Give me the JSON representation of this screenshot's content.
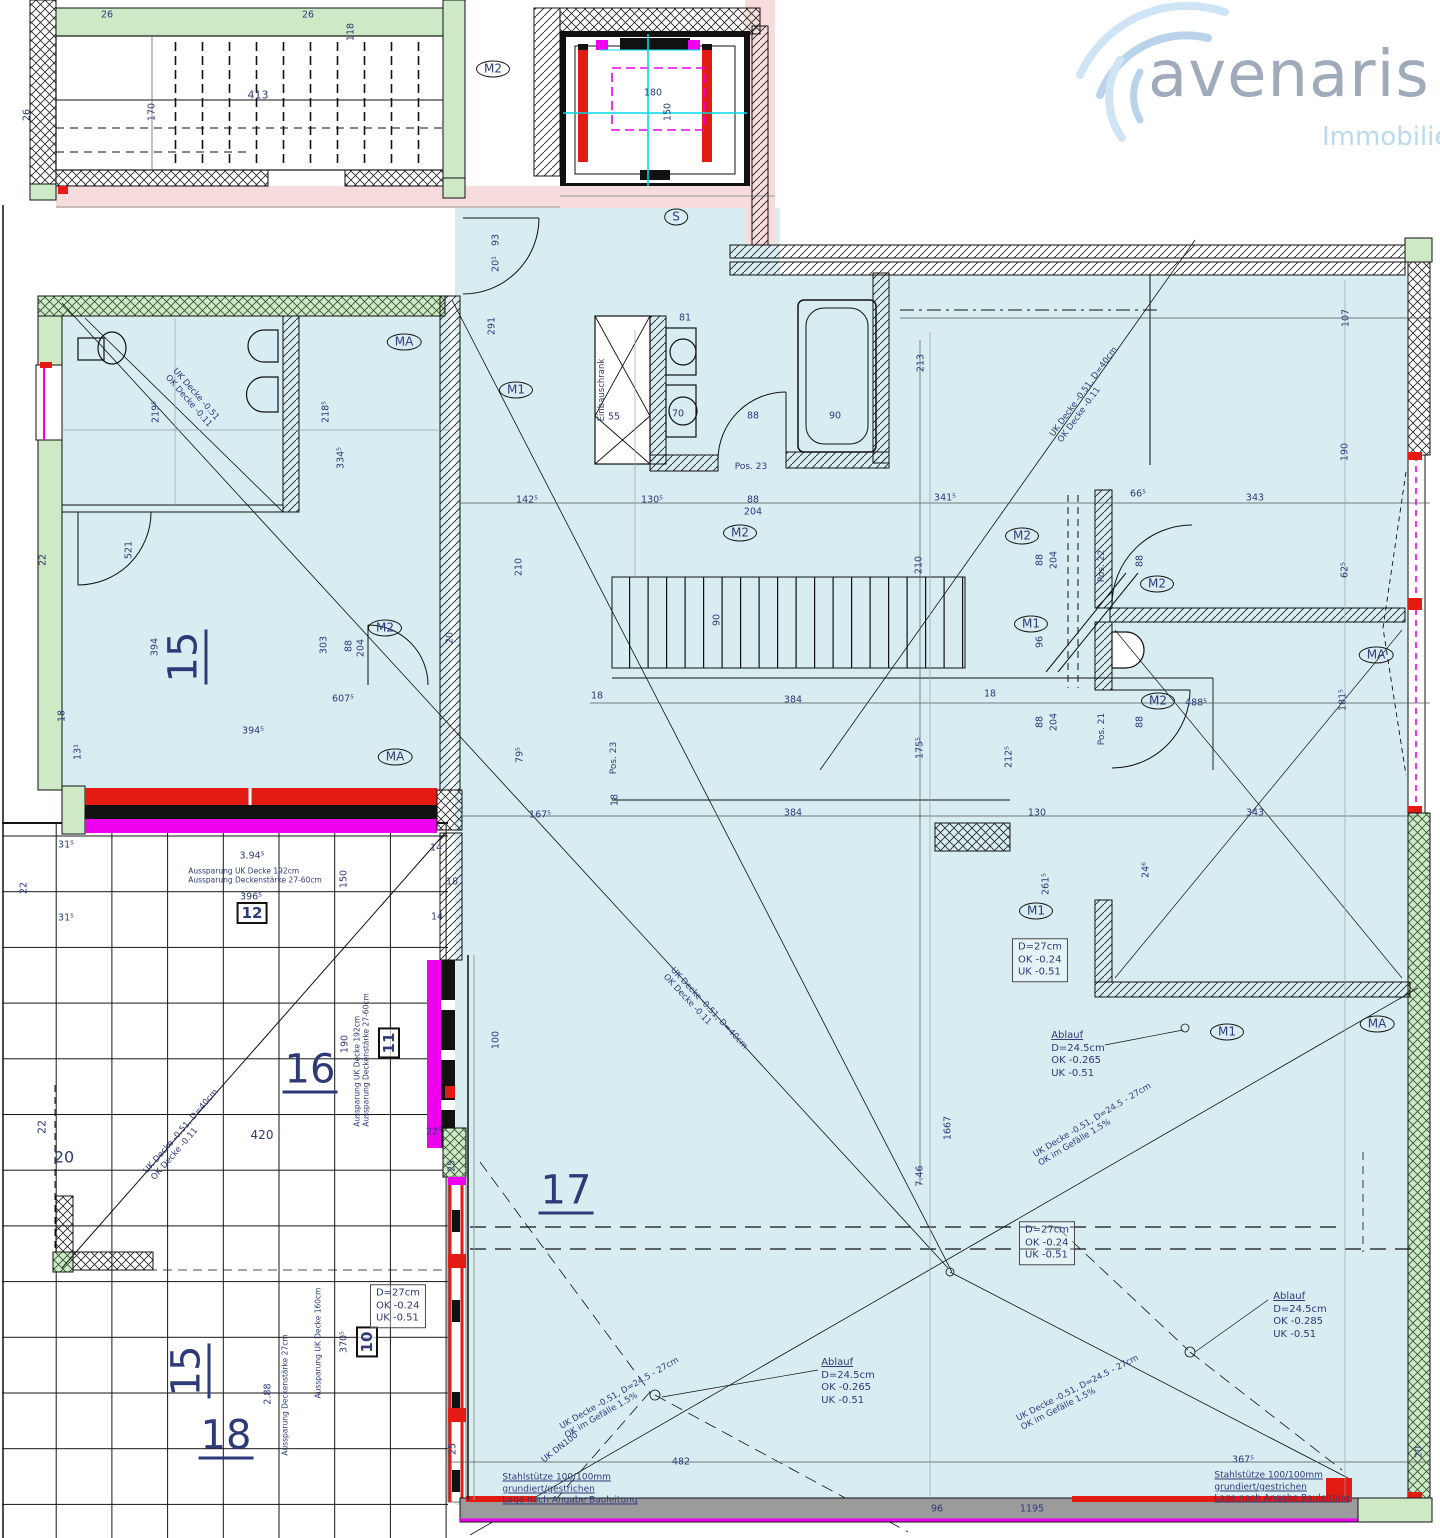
{
  "logo": {
    "brand": "avenaris",
    "subtitle": "Immobilien"
  },
  "colors": {
    "room_fill": "#d8edf2",
    "wall_green": "#cde9c6",
    "pink": "#f6dcdc",
    "magenta": "#ee00ee",
    "red": "#e31b12",
    "cyan": "#00d8e8",
    "text_navy": "#2e3a78",
    "wall_gray": "#9b9b9b",
    "logo_text": "#9faaba",
    "logo_sub": "#bcd9ec"
  },
  "plan": {
    "labels": [
      {
        "t": "26",
        "x": 107,
        "y": 15,
        "cls": "dim"
      },
      {
        "t": "26",
        "x": 308,
        "y": 15,
        "cls": "dim"
      },
      {
        "t": "413",
        "x": 258,
        "y": 95,
        "cls": "dim",
        "s": 11
      },
      {
        "t": "118",
        "x": 351,
        "y": 32,
        "r": -90,
        "cls": "dim"
      },
      {
        "t": "170",
        "x": 152,
        "y": 112,
        "r": -90,
        "cls": "dim"
      },
      {
        "t": "26",
        "x": 27,
        "y": 115,
        "r": -90,
        "cls": "dim"
      },
      {
        "t": "180",
        "x": 653,
        "y": 93,
        "cls": "dim"
      },
      {
        "t": "150",
        "x": 668,
        "y": 112,
        "r": -90,
        "cls": "dim"
      },
      {
        "t": "93",
        "x": 496,
        "y": 240,
        "r": -90,
        "cls": "dim"
      },
      {
        "t": "20¹",
        "x": 496,
        "y": 264,
        "r": -90,
        "cls": "dim"
      },
      {
        "t": "291",
        "x": 492,
        "y": 326,
        "r": -90,
        "cls": "dim"
      },
      {
        "t": "81",
        "x": 685,
        "y": 318,
        "cls": "dim"
      },
      {
        "t": "55",
        "x": 614,
        "y": 417,
        "cls": "dim"
      },
      {
        "t": "70",
        "x": 678,
        "y": 414,
        "cls": "dim"
      },
      {
        "t": "88",
        "x": 753,
        "y": 416,
        "cls": "dim"
      },
      {
        "t": "90",
        "x": 835,
        "y": 416,
        "cls": "dim"
      },
      {
        "t": "213",
        "x": 921,
        "y": 363,
        "r": -90,
        "cls": "dim"
      },
      {
        "t": "219⁵",
        "x": 156,
        "y": 412,
        "r": -90,
        "cls": "dim"
      },
      {
        "t": "218⁵",
        "x": 326,
        "y": 412,
        "r": -90,
        "cls": "dim"
      },
      {
        "t": "334⁵",
        "x": 341,
        "y": 458,
        "r": -90,
        "cls": "dim"
      },
      {
        "t": "142⁵",
        "x": 527,
        "y": 500,
        "cls": "dim"
      },
      {
        "t": "130⁵",
        "x": 652,
        "y": 500,
        "cls": "dim"
      },
      {
        "t": "88",
        "x": 753,
        "y": 500,
        "cls": "dim"
      },
      {
        "t": "204",
        "x": 753,
        "y": 512,
        "cls": "dim"
      },
      {
        "t": "341⁵",
        "x": 945,
        "y": 498,
        "cls": "dim"
      },
      {
        "t": "66⁵",
        "x": 1138,
        "y": 494,
        "cls": "dim"
      },
      {
        "t": "343",
        "x": 1255,
        "y": 498,
        "cls": "dim"
      },
      {
        "t": "107",
        "x": 1346,
        "y": 318,
        "r": -90,
        "cls": "dim"
      },
      {
        "t": "190",
        "x": 1345,
        "y": 452,
        "r": -90,
        "cls": "dim"
      },
      {
        "t": "62⁵",
        "x": 1345,
        "y": 570,
        "r": -90,
        "cls": "dim"
      },
      {
        "t": "181⁵",
        "x": 1343,
        "y": 700,
        "r": -90,
        "cls": "dim"
      },
      {
        "t": "488⁵",
        "x": 1196,
        "y": 703,
        "cls": "dim"
      },
      {
        "t": "88",
        "x": 1040,
        "y": 560,
        "r": -90,
        "cls": "dim"
      },
      {
        "t": "204",
        "x": 1054,
        "y": 560,
        "r": -90,
        "cls": "dim"
      },
      {
        "t": "88",
        "x": 1140,
        "y": 561,
        "r": -90,
        "cls": "dim"
      },
      {
        "t": "96",
        "x": 1040,
        "y": 642,
        "r": -90,
        "cls": "dim"
      },
      {
        "t": "88",
        "x": 1040,
        "y": 722,
        "r": -90,
        "cls": "dim"
      },
      {
        "t": "204",
        "x": 1054,
        "y": 722,
        "r": -90,
        "cls": "dim"
      },
      {
        "t": "88",
        "x": 1140,
        "y": 722,
        "r": -90,
        "cls": "dim"
      },
      {
        "t": "210",
        "x": 519,
        "y": 567,
        "r": -90,
        "cls": "dim"
      },
      {
        "t": "210",
        "x": 919,
        "y": 565,
        "r": -90,
        "cls": "dim"
      },
      {
        "t": "90",
        "x": 717,
        "y": 620,
        "r": -90,
        "cls": "dim"
      },
      {
        "t": "521",
        "x": 129,
        "y": 550,
        "r": -90,
        "cls": "dim"
      },
      {
        "t": "394",
        "x": 155,
        "y": 647,
        "r": -90,
        "cls": "dim"
      },
      {
        "t": "303",
        "x": 324,
        "y": 645,
        "r": -90,
        "cls": "dim"
      },
      {
        "t": "88",
        "x": 349,
        "y": 646,
        "r": -90,
        "cls": "dim"
      },
      {
        "t": "204",
        "x": 361,
        "y": 648,
        "r": -90,
        "cls": "dim"
      },
      {
        "t": "22",
        "x": 43,
        "y": 560,
        "r": -90,
        "cls": "dim"
      },
      {
        "t": "18",
        "x": 62,
        "y": 716,
        "r": -90,
        "cls": "dim"
      },
      {
        "t": "13¹",
        "x": 78,
        "y": 752,
        "r": -90,
        "cls": "dim"
      },
      {
        "t": "607⁵",
        "x": 343,
        "y": 699,
        "cls": "dim"
      },
      {
        "t": "394⁵",
        "x": 253,
        "y": 731,
        "cls": "dim"
      },
      {
        "t": "20",
        "x": 450,
        "y": 638,
        "r": -90,
        "cls": "dim"
      },
      {
        "t": "18",
        "x": 597,
        "y": 696,
        "cls": "dim"
      },
      {
        "t": "384",
        "x": 793,
        "y": 700,
        "cls": "dim"
      },
      {
        "t": "18",
        "x": 990,
        "y": 694,
        "cls": "dim"
      },
      {
        "t": "175⁵",
        "x": 920,
        "y": 748,
        "r": -90,
        "cls": "dim"
      },
      {
        "t": "212⁵",
        "x": 1009,
        "y": 757,
        "r": -90,
        "cls": "dim"
      },
      {
        "t": "18",
        "x": 615,
        "y": 800,
        "r": -90,
        "cls": "dim"
      },
      {
        "t": "384",
        "x": 793,
        "y": 813,
        "cls": "dim"
      },
      {
        "t": "130",
        "x": 1037,
        "y": 813,
        "cls": "dim"
      },
      {
        "t": "343",
        "x": 1255,
        "y": 813,
        "cls": "dim"
      },
      {
        "t": "167⁵",
        "x": 540,
        "y": 815,
        "cls": "dim"
      },
      {
        "t": "79⁵",
        "x": 520,
        "y": 755,
        "r": -90,
        "cls": "dim"
      },
      {
        "t": "261⁵",
        "x": 1046,
        "y": 884,
        "r": -90,
        "cls": "dim"
      },
      {
        "t": "24⁶",
        "x": 1146,
        "y": 870,
        "r": -90,
        "cls": "dim"
      },
      {
        "t": "31⁵",
        "x": 66,
        "y": 845,
        "cls": "dim"
      },
      {
        "t": "22",
        "x": 24,
        "y": 888,
        "r": -90,
        "cls": "dim"
      },
      {
        "t": "31⁵",
        "x": 66,
        "y": 918,
        "cls": "dim"
      },
      {
        "t": "3.94⁵",
        "x": 252,
        "y": 856,
        "cls": "dim"
      },
      {
        "t": "396⁵",
        "x": 251,
        "y": 897,
        "cls": "dim"
      },
      {
        "t": "150",
        "x": 344,
        "y": 879,
        "r": -90,
        "cls": "dim"
      },
      {
        "t": "14",
        "x": 436,
        "y": 848,
        "cls": "dim"
      },
      {
        "t": "18",
        "x": 452,
        "y": 882,
        "cls": "dim"
      },
      {
        "t": "14",
        "x": 437,
        "y": 917,
        "cls": "dim"
      },
      {
        "t": "190",
        "x": 345,
        "y": 1044,
        "r": -90,
        "cls": "dim"
      },
      {
        "t": "100",
        "x": 496,
        "y": 1040,
        "r": -90,
        "cls": "dim"
      },
      {
        "t": "22⁵",
        "x": 434,
        "y": 1132,
        "cls": "dim"
      },
      {
        "t": "25",
        "x": 452,
        "y": 1166,
        "r": -90,
        "cls": "dim"
      },
      {
        "t": "420",
        "x": 262,
        "y": 1135,
        "cls": "dim",
        "s": 12
      },
      {
        "t": "20",
        "x": 64,
        "y": 1157,
        "cls": "dim",
        "s": 16
      },
      {
        "t": "22",
        "x": 42,
        "y": 1127,
        "r": -90,
        "cls": "dim",
        "s": 11
      },
      {
        "t": "1667",
        "x": 948,
        "y": 1128,
        "r": -90,
        "cls": "dim"
      },
      {
        "t": "7.46",
        "x": 920,
        "y": 1176,
        "r": -90,
        "cls": "dim"
      },
      {
        "t": "370⁵",
        "x": 344,
        "y": 1342,
        "r": -90,
        "cls": "dim"
      },
      {
        "t": "2.88",
        "x": 268,
        "y": 1394,
        "r": -90,
        "cls": "dim"
      },
      {
        "t": "482",
        "x": 681,
        "y": 1462,
        "cls": "dim"
      },
      {
        "t": "96",
        "x": 937,
        "y": 1509,
        "cls": "dim"
      },
      {
        "t": "1195",
        "x": 1032,
        "y": 1509,
        "cls": "dim"
      },
      {
        "t": "367⁵",
        "x": 1243,
        "y": 1460,
        "cls": "dim"
      },
      {
        "t": "20",
        "x": 1419,
        "y": 1452,
        "r": -90,
        "cls": "dim"
      },
      {
        "t": "25",
        "x": 453,
        "y": 1449,
        "r": -90,
        "cls": "dim"
      },
      {
        "t": "M2",
        "x": 493,
        "y": 69,
        "cls": "marker"
      },
      {
        "t": "S",
        "x": 676,
        "y": 217,
        "cls": "marker"
      },
      {
        "t": "MA",
        "x": 404,
        "y": 342,
        "cls": "marker"
      },
      {
        "t": "M1",
        "x": 516,
        "y": 390,
        "cls": "marker"
      },
      {
        "t": "M2",
        "x": 740,
        "y": 533,
        "cls": "marker"
      },
      {
        "t": "M2",
        "x": 1022,
        "y": 536,
        "cls": "marker"
      },
      {
        "t": "M2",
        "x": 1157,
        "y": 584,
        "cls": "marker"
      },
      {
        "t": "M1",
        "x": 1031,
        "y": 624,
        "cls": "marker"
      },
      {
        "t": "M2",
        "x": 1158,
        "y": 701,
        "cls": "marker"
      },
      {
        "t": "MA",
        "x": 1376,
        "y": 655,
        "cls": "marker"
      },
      {
        "t": "M2",
        "x": 385,
        "y": 628,
        "cls": "marker"
      },
      {
        "t": "MA",
        "x": 395,
        "y": 757,
        "cls": "marker"
      },
      {
        "t": "M1",
        "x": 1036,
        "y": 911,
        "cls": "marker"
      },
      {
        "t": "M1",
        "x": 1227,
        "y": 1032,
        "cls": "marker"
      },
      {
        "t": "MA",
        "x": 1377,
        "y": 1024,
        "cls": "marker"
      },
      {
        "t": "Pos. 23",
        "x": 751,
        "y": 467,
        "cls": "pos"
      },
      {
        "t": "Pos. 23",
        "x": 614,
        "y": 758,
        "r": -90,
        "cls": "pos"
      },
      {
        "t": "Pos. 22",
        "x": 1102,
        "y": 566,
        "r": -90,
        "cls": "pos"
      },
      {
        "t": "Pos. 21",
        "x": 1102,
        "y": 729,
        "r": -90,
        "cls": "pos"
      },
      {
        "t": "12",
        "x": 252,
        "y": 913,
        "cls": "box"
      },
      {
        "t": "11",
        "x": 389,
        "y": 1043,
        "r": -90,
        "cls": "box"
      },
      {
        "t": "10",
        "x": 367,
        "y": 1342,
        "r": -90,
        "cls": "box"
      },
      {
        "t": "15",
        "x": 185,
        "y": 657,
        "r": -90,
        "cls": "room"
      },
      {
        "t": "16",
        "x": 310,
        "y": 1071,
        "cls": "room"
      },
      {
        "t": "17",
        "x": 566,
        "y": 1192,
        "cls": "room"
      },
      {
        "t": "15",
        "x": 188,
        "y": 1371,
        "r": -90,
        "cls": "room"
      },
      {
        "t": "18",
        "x": 226,
        "y": 1437,
        "cls": "room"
      }
    ],
    "blocks": [
      {
        "cls": "anno",
        "x": 1040,
        "y": 960,
        "lines": [
          "D=27cm",
          "OK -0.24",
          "UK -0.51"
        ]
      },
      {
        "cls": "anno",
        "x": 1047,
        "y": 1243,
        "lines": [
          "D=27cm",
          "OK -0.24",
          "UK -0.51"
        ]
      },
      {
        "cls": "anno",
        "x": 398,
        "y": 1306,
        "lines": [
          "D=27cm",
          "OK -0.24",
          "UK -0.51"
        ]
      },
      {
        "cls": "ablauf",
        "x": 1078,
        "y": 1055,
        "lines": [
          "Ablauf",
          "D=24.5cm",
          "OK -0.265",
          "UK  -0.51"
        ]
      },
      {
        "cls": "ablauf",
        "x": 848,
        "y": 1382,
        "lines": [
          "Ablauf",
          "D=24.5cm",
          "OK -0.265",
          "UK  -0.51"
        ]
      },
      {
        "cls": "ablauf",
        "x": 1300,
        "y": 1316,
        "lines": [
          "Ablauf",
          "D=24.5cm",
          "OK -0.285",
          "UK  -0.51"
        ]
      },
      {
        "cls": "steel",
        "x": 570,
        "y": 1490,
        "lines": [
          "Stahlstütze 100/100mm",
          "grundiert/gestrichen",
          "Lage nach Angabe Bauleitung"
        ]
      },
      {
        "cls": "steel",
        "x": 1282,
        "y": 1488,
        "lines": [
          "Stahlstütze 100/100mm",
          "grundiert/gestrichen",
          "Lage nach Angabe Bauleitung"
        ]
      },
      {
        "cls": "diag",
        "x": 192,
        "y": 398,
        "r": 49,
        "lines": [
          "UK Decke -0.51",
          "OK Decke -0.11"
        ]
      },
      {
        "cls": "diag",
        "x": 1088,
        "y": 395,
        "r": -54,
        "lines": [
          "UK Decke -0.51, D=40cm",
          "OK Decke -0.11"
        ]
      },
      {
        "cls": "diag",
        "x": 185,
        "y": 1135,
        "r": -49,
        "lines": [
          "UK Decke -0.51, D=40cm",
          "OK Decke -0.11"
        ]
      },
      {
        "cls": "diag",
        "x": 705,
        "y": 1012,
        "r": 47,
        "lines": [
          "UK Decke -0.51, D=40cm",
          "OK Decke -0.11"
        ]
      },
      {
        "cls": "diag",
        "x": 1095,
        "y": 1125,
        "r": -31,
        "lines": [
          "UK Decke -0.51, D=24.5 - 27cm",
          "OK im Gefälle 1.5%"
        ]
      },
      {
        "cls": "diag",
        "x": 622,
        "y": 1398,
        "r": -30,
        "lines": [
          "UK Decke -0.51, D=24.5 - 27cm",
          "OK im Gefälle 1.5%"
        ]
      },
      {
        "cls": "diag",
        "x": 1080,
        "y": 1393,
        "r": -27,
        "lines": [
          "UK Decke -0.51, D=24.5 - 27cm",
          "OK im Gefälle 1.5%"
        ]
      },
      {
        "cls": "diag",
        "x": 560,
        "y": 1448,
        "r": -38,
        "lines": [
          "UK DN100"
        ]
      },
      {
        "cls": "diag",
        "x": 602,
        "y": 390,
        "r": -90,
        "lines": [
          "Einbauschrank"
        ]
      },
      {
        "cls": "auss",
        "x": 255,
        "y": 876,
        "lines": [
          "Aussparung UK Decke 192cm",
          "Aussparung Deckenstärke 27-60cm"
        ]
      },
      {
        "cls": "auss",
        "x": 362,
        "y": 1060,
        "r": -90,
        "lines": [
          "Aussparung UK Decke 192cm",
          "Aussparung Deckenstärke 27-60cm"
        ]
      },
      {
        "cls": "auss",
        "x": 285,
        "y": 1395,
        "r": -90,
        "lines": [
          "Aussparung Deckenstärke 27cm"
        ]
      },
      {
        "cls": "auss",
        "x": 318,
        "y": 1343,
        "r": -90,
        "lines": [
          "Aussparung UK Decke 160cm"
        ]
      }
    ]
  }
}
